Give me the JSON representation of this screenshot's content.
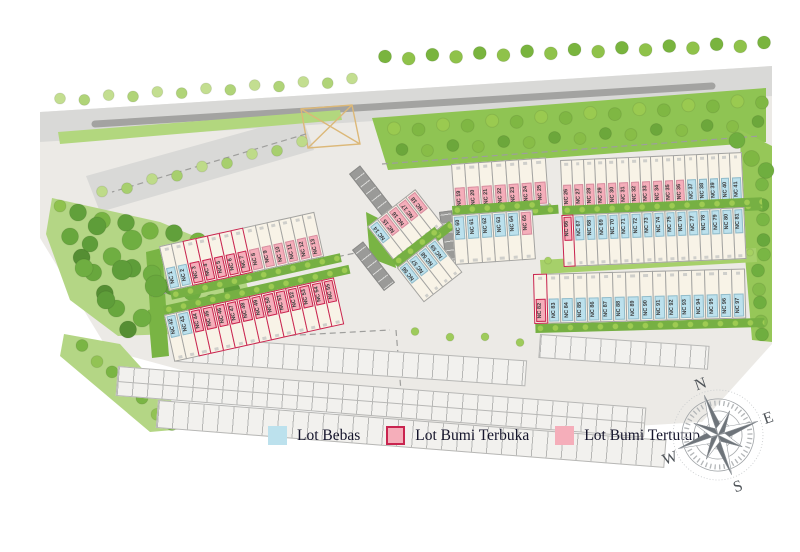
{
  "legend": {
    "items": [
      {
        "id": "lot-bebas",
        "label": "Lot Bebas",
        "fill": "#bce1ed",
        "border": "none"
      },
      {
        "id": "lot-bumi-terbuka",
        "label": "Lot Bumi Terbuka",
        "fill": "#f5aeba",
        "border": "2.5px solid #c9244f"
      },
      {
        "id": "lot-bumi-tertutup",
        "label": "Lot Bumi Tertutup",
        "fill": "#f5aeba",
        "border": "none"
      }
    ]
  },
  "compass": {
    "north": "N",
    "east": "E",
    "south": "S",
    "west": "W"
  },
  "colors": {
    "lot_bebas": "#bce1ed",
    "lot_bumi_terbuka_fill": "#f5aeba",
    "lot_bumi_terbuka_outline": "#c9244f",
    "lot_bumi_tertutup": "#f5aeba",
    "lot_unmarked": "#f8f3e7",
    "green": "#76b043",
    "road": "#d9d9d7",
    "ground": "#eceae6"
  },
  "blocks": [
    {
      "id": "a",
      "x": 160,
      "y": 246,
      "angle": -12.5,
      "lot_w": 13.2,
      "lot_h": 46,
      "band": "bottom",
      "green": "bottom",
      "lots": [
        [
          "NC 1",
          "bebas"
        ],
        [
          "NC 2",
          "bebas"
        ],
        [
          "NC 3",
          "terbuka"
        ],
        [
          "NC 4",
          "terbuka"
        ],
        [
          "NC 5",
          "terbuka"
        ],
        [
          "NC 6",
          "terbuka"
        ],
        [
          "NC 7",
          "terbuka"
        ],
        [
          "NC 8",
          "tertutup"
        ],
        [
          "NC 9",
          "tertutup"
        ],
        [
          "NC 10",
          "tertutup"
        ],
        [
          "NC 11",
          "tertutup"
        ],
        [
          "NC 12",
          "tertutup"
        ],
        [
          "NC 13",
          "tertutup"
        ]
      ]
    },
    {
      "id": "b",
      "x": 163,
      "y": 306,
      "angle": -12.5,
      "lot_w": 13.4,
      "lot_h": 48,
      "band": "top",
      "green": "top",
      "lots": [
        [
          "NC 42",
          "bebas"
        ],
        [
          "NC 43",
          "bebas"
        ],
        [
          "NC 44",
          "terbuka"
        ],
        [
          "NC 45",
          "terbuka"
        ],
        [
          "NC 46",
          "terbuka"
        ],
        [
          "NC 47",
          "terbuka"
        ],
        [
          "NC 48",
          "terbuka"
        ],
        [
          "NC 49",
          "terbuka"
        ],
        [
          "NC 50",
          "terbuka"
        ],
        [
          "NC 51",
          "terbuka"
        ],
        [
          "NC 52",
          "terbuka"
        ],
        [
          "NC 53",
          "terbuka"
        ],
        [
          "NC 54",
          "terbuka"
        ],
        [
          "NC 55",
          "terbuka"
        ]
      ]
    },
    {
      "id": "c",
      "x": 368,
      "y": 226,
      "angle": -38,
      "lot_w": 13,
      "lot_h": 46,
      "band": "top",
      "green": "bottom",
      "lots": [
        [
          "NC 14",
          "bebas"
        ],
        [
          "NC 15",
          "tertutup"
        ],
        [
          "NC 16",
          "tertutup"
        ],
        [
          "NC 17",
          "tertutup"
        ],
        [
          "NC 18",
          "tertutup"
        ]
      ]
    },
    {
      "id": "d",
      "x": 392,
      "y": 260,
      "angle": -38,
      "lot_w": 13,
      "lot_h": 44,
      "band": "top",
      "green": "top",
      "lots": [
        [
          "NC 56",
          "bebas"
        ],
        [
          "NC 57",
          "bebas"
        ],
        [
          "NC 58",
          "bebas"
        ],
        [
          "NC 59",
          "bebas"
        ]
      ]
    },
    {
      "id": "e",
      "x": 452,
      "y": 164,
      "angle": -4,
      "lot_w": 14.4,
      "lot_h": 48,
      "band": "bottom",
      "green": "bottom",
      "lots": [
        [
          "NC 19",
          "tertutup"
        ],
        [
          "NC 20",
          "tertutup"
        ],
        [
          "NC 21",
          "tertutup"
        ],
        [
          "NC 22",
          "tertutup"
        ],
        [
          "NC 23",
          "tertutup"
        ],
        [
          "NC 24",
          "tertutup"
        ],
        [
          "NC 25",
          "tertutup"
        ]
      ]
    },
    {
      "id": "f",
      "x": 561,
      "y": 160,
      "angle": -2.5,
      "lot_w": 12.3,
      "lot_h": 50,
      "band": "bottom",
      "green": "bottom",
      "lots": [
        [
          "NC 26",
          "tertutup"
        ],
        [
          "NC 27",
          "tertutup"
        ],
        [
          "NC 28",
          "tertutup"
        ],
        [
          "NC 29",
          "tertutup"
        ],
        [
          "NC 30",
          "tertutup"
        ],
        [
          "NC 31",
          "tertutup"
        ],
        [
          "NC 32",
          "tertutup"
        ],
        [
          "NC 33",
          "tertutup"
        ],
        [
          "NC 34",
          "tertutup"
        ],
        [
          "NC 35",
          "tertutup"
        ],
        [
          "NC 36",
          "tertutup"
        ],
        [
          "NC 37",
          "bebas"
        ],
        [
          "NC 38",
          "bebas"
        ],
        [
          "NC 39",
          "bebas"
        ],
        [
          "NC 40",
          "bebas"
        ],
        [
          "NC 41",
          "bebas"
        ]
      ]
    },
    {
      "id": "g",
      "x": 452,
      "y": 206,
      "angle": -4,
      "lot_w": 14.4,
      "lot_h": 50,
      "band": "top",
      "green": "top",
      "lots": [
        [
          "NC 60",
          "bebas"
        ],
        [
          "NC 61",
          "bebas"
        ],
        [
          "NC 62",
          "bebas"
        ],
        [
          "NC 63",
          "bebas"
        ],
        [
          "NC 64",
          "bebas"
        ],
        [
          "NC 65",
          "tertutup"
        ]
      ]
    },
    {
      "id": "h",
      "x": 562,
      "y": 206,
      "angle": -2.5,
      "lot_w": 12.4,
      "lot_h": 52,
      "band": "top",
      "green": "top",
      "lots": [
        [
          "NC 66",
          "terbuka"
        ],
        [
          "NC 67",
          "bebas"
        ],
        [
          "NC 68",
          "bebas"
        ],
        [
          "NC 69",
          "bebas"
        ],
        [
          "NC 70",
          "bebas"
        ],
        [
          "NC 71",
          "bebas"
        ],
        [
          "NC 72",
          "bebas"
        ],
        [
          "NC 73",
          "bebas"
        ],
        [
          "NC 74",
          "bebas"
        ],
        [
          "NC 75",
          "bebas"
        ],
        [
          "NC 76",
          "bebas"
        ],
        [
          "NC 77",
          "bebas"
        ],
        [
          "NC 78",
          "bebas"
        ],
        [
          "NC 79",
          "bebas"
        ],
        [
          "NC 80",
          "bebas"
        ],
        [
          "NC 81",
          "bebas"
        ]
      ]
    },
    {
      "id": "i",
      "x": 534,
      "y": 274,
      "angle": -1.5,
      "lot_w": 14.2,
      "lot_h": 50,
      "band": "bottom",
      "green": "bottom",
      "lots": [
        [
          "NC 82",
          "terbuka"
        ],
        [
          "NC 83",
          "bebas"
        ],
        [
          "NC 84",
          "bebas"
        ],
        [
          "NC 85",
          "bebas"
        ],
        [
          "NC 86",
          "bebas"
        ],
        [
          "NC 87",
          "bebas"
        ],
        [
          "NC 88",
          "bebas"
        ],
        [
          "NC 89",
          "bebas"
        ],
        [
          "NC 90",
          "bebas"
        ],
        [
          "NC 91",
          "bebas"
        ],
        [
          "NC 92",
          "bebas"
        ],
        [
          "NC 93",
          "bebas"
        ],
        [
          "NC 94",
          "bebas"
        ],
        [
          "NC 95",
          "bebas"
        ],
        [
          "NC 96",
          "bebas"
        ],
        [
          "NC 97",
          "bebas"
        ]
      ]
    }
  ]
}
